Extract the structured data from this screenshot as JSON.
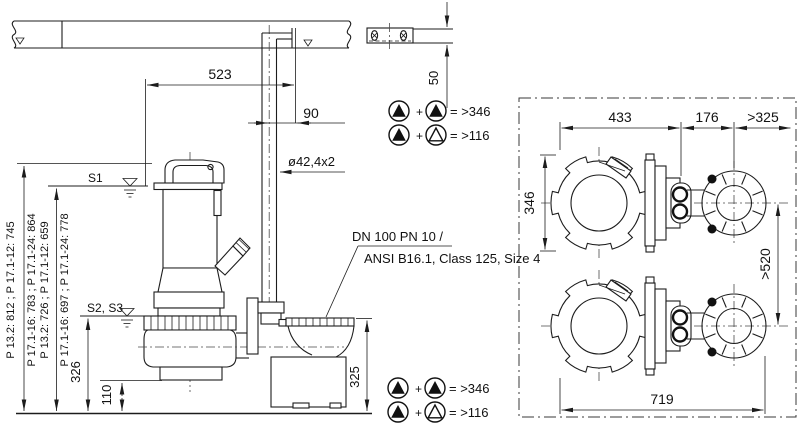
{
  "side_view": {
    "dim_523": "523",
    "dim_90": "90",
    "dim_50": "50",
    "pipe_spec": "ø42,4x2",
    "level_s1": "S1",
    "level_s2s3": "S2, S3",
    "dim_326": "326",
    "dim_110": "110",
    "dim_325": "325",
    "flange_label_line1": "DN 100 PN 10 /",
    "flange_label_line2": "ANSI B16.1, Class 125, Size 4",
    "pump_height_labels": [
      "P 13.2: 812 ; P 17.1-12: 745",
      "P 17.1-16: 783 ; P 17.1-24: 864",
      "P 13.2: 726 ; P 17.1-12: 659",
      "P 17.1-16: 697 ; P 17.1-24: 778"
    ]
  },
  "plan_view": {
    "dim_433": "433",
    "dim_176": "176",
    "dim_min_325": ">325",
    "dim_346": "346",
    "dim_min_520": ">520",
    "dim_719": "719"
  },
  "legend": {
    "plus": "+",
    "duty_duty_clearance": "= >346",
    "duty_standby_clearance": "= >116"
  }
}
